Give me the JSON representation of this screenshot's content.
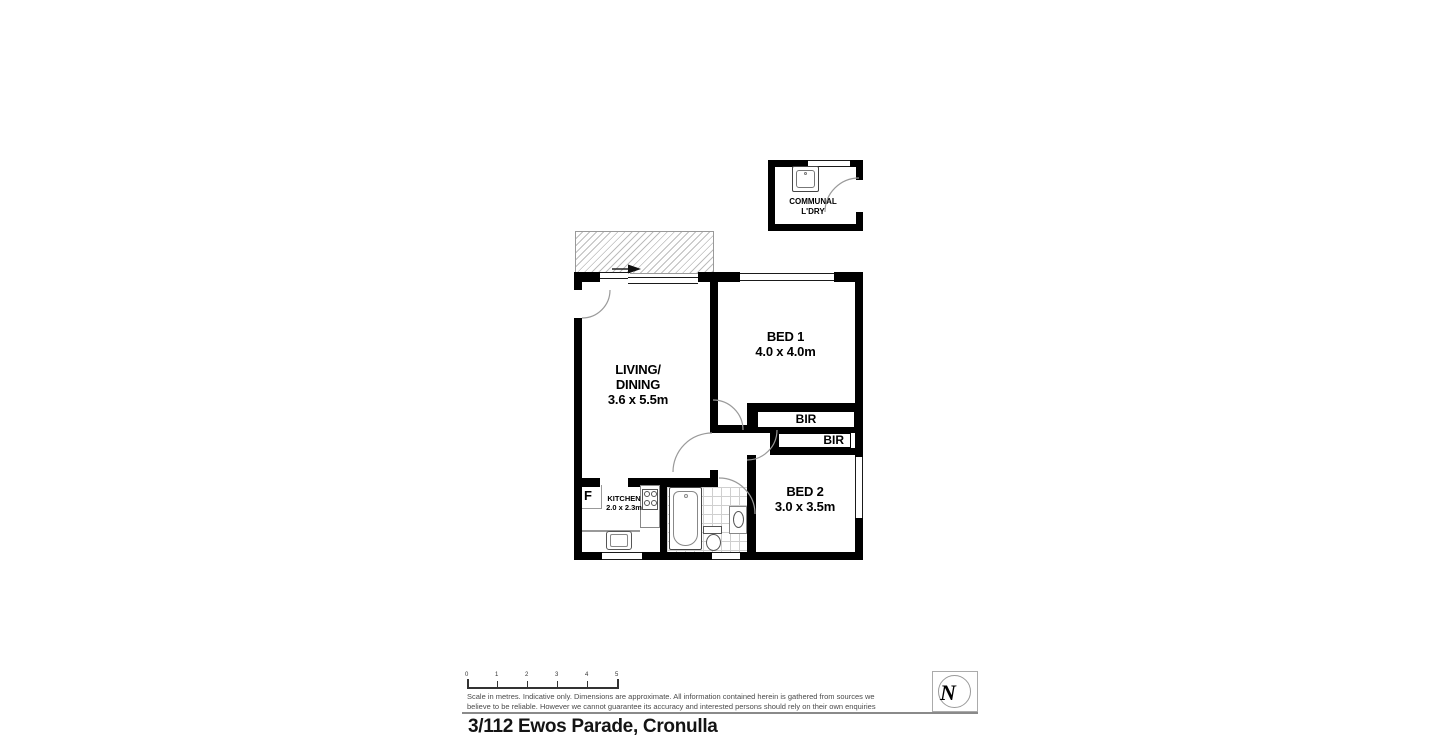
{
  "plan": {
    "laundry": {
      "line1": "COMMUNAL",
      "line2": "L'DRY"
    },
    "living": {
      "line1": "LIVING/",
      "line2": "DINING",
      "dims": "3.6 x 5.5m"
    },
    "bed1": {
      "name": "BED 1",
      "dims": "4.0 x 4.0m"
    },
    "bed2": {
      "name": "BED 2",
      "dims": "3.0 x 3.5m"
    },
    "kitchen": {
      "name": "KITCHEN",
      "dims": "2.0 x 2.3m"
    },
    "fridge": {
      "label": "F"
    },
    "bir1": {
      "label": "BIR"
    },
    "bir2": {
      "label": "BIR"
    }
  },
  "footer": {
    "scale_ticks": [
      "0",
      "1",
      "2",
      "3",
      "4",
      "5"
    ],
    "disclaimer1": "Scale in metres. Indicative only. Dimensions are approximate. All information contained herein is gathered from sources we",
    "disclaimer2": "believe to be reliable. However we cannot guarantee its accuracy and interested persons should rely on their own enquiries",
    "north_label": "N",
    "address": "3/112 Ewos Parade, Cronulla"
  },
  "colors": {
    "wall": "#000000",
    "thin_line": "#8a8a8a",
    "muted_text": "#4a4a4a"
  }
}
